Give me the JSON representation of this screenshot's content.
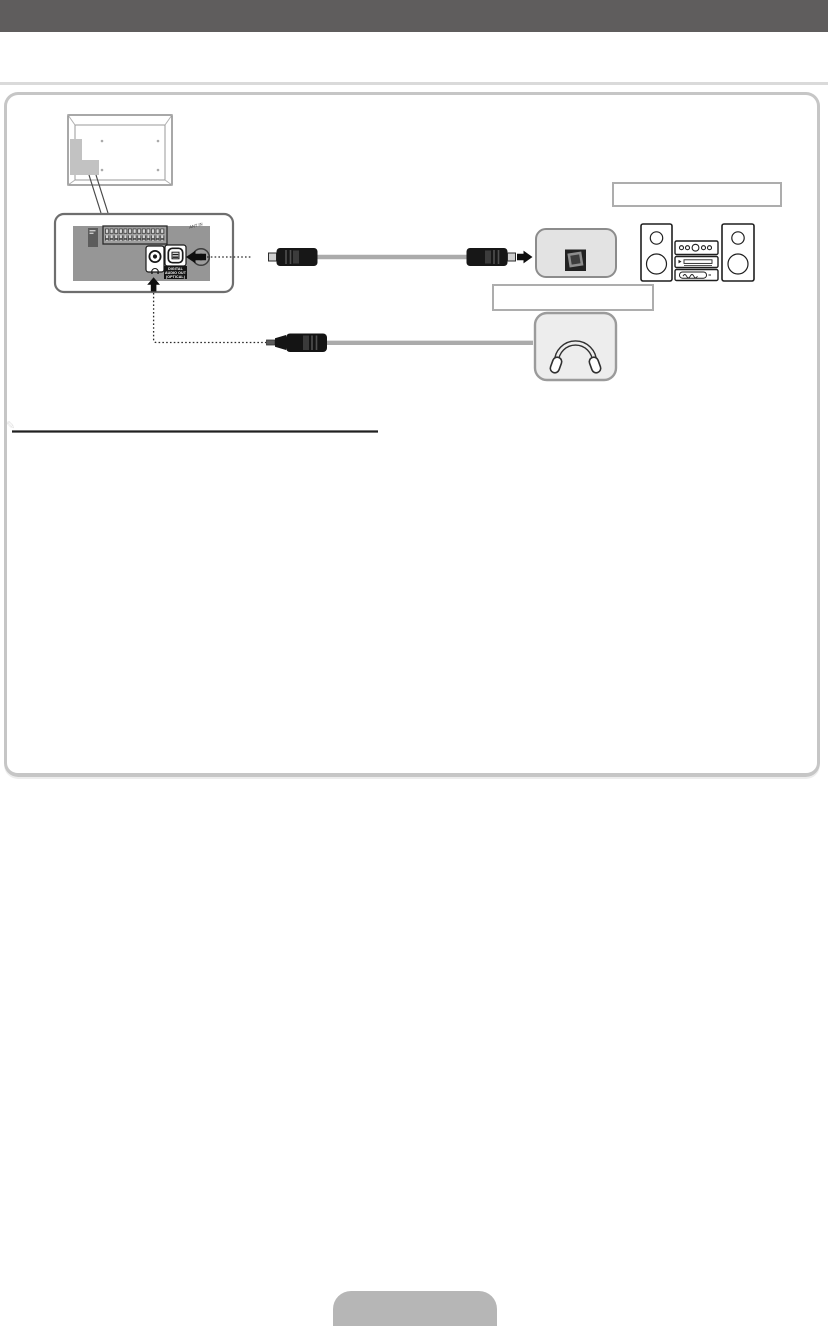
{
  "document": {
    "kind": "tv-user-manual-connection-page",
    "header_bar_color": "#5F5D5D",
    "frame_border_color": "#C6C6C6",
    "footer_tab_color": "#B6B6B6"
  },
  "diagram": {
    "tv_rear_panel": {
      "digital_audio_out_label": "DIGITAL AUDIO OUT (OPTICAL)",
      "ant_in_label": "ANT IN"
    },
    "captions": {
      "audio_system_caption": "",
      "optical_jack_caption": ""
    },
    "note": {
      "pencil_glyph": "✎"
    },
    "footer_tab_label": "",
    "icons": {
      "headphones": "svg-headphones-arc-with-ear-pads",
      "optical_cable": "svg-toslink-cable",
      "audio_plug_3_5mm": "svg-mini-jack-plug",
      "mini_audio_system": "svg-hifi-speakers-stack",
      "arrow_left": "svg-solid-arrow",
      "arrow_right": "svg-solid-arrow",
      "arrow_up": "svg-solid-arrow",
      "note_pencil": "✎"
    }
  }
}
